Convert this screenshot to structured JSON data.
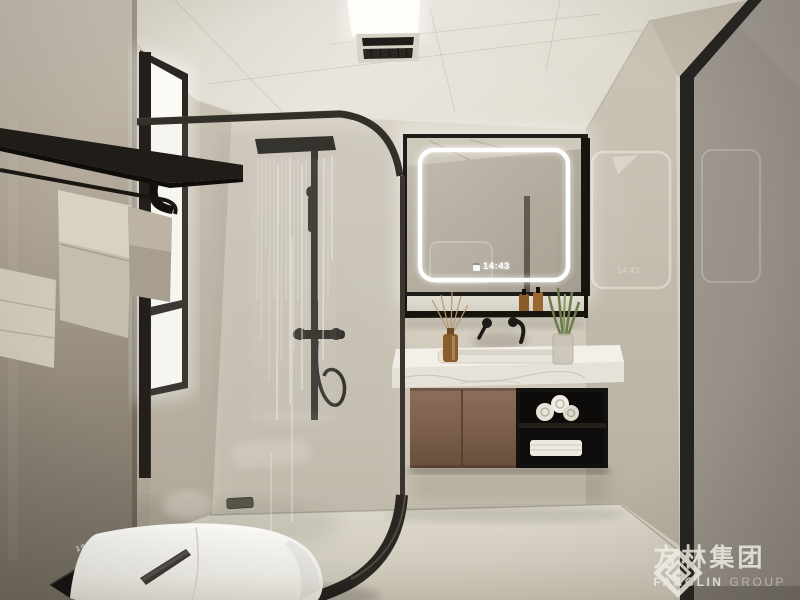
{
  "mirror": {
    "time": "14:43",
    "icon": "clock-display-icon"
  },
  "wall_reflection": {
    "time": "14:43"
  },
  "toilet": {
    "display_value": "190"
  },
  "watermark": {
    "logo": "fanglin-diamond-logo",
    "company_cn": "方林集团",
    "company_en": "FANGLIN",
    "company_en_suffix": "GROUP"
  },
  "colors": {
    "ceiling": "#e7e3da",
    "back_wall": "#d3ccbe",
    "pillar_taupe": "#9a9082",
    "door_gray": "#97918a",
    "black_fixture": "#22201c",
    "wood_cabinet": "#7d614e",
    "marble_white": "#f2efe9",
    "floor": "#d6d0c3",
    "led_white": "#ffffff",
    "towel_beige": "#d4cdbd",
    "plant_green": "#6d7c4a",
    "amber_bottle": "#8a5e2c"
  }
}
